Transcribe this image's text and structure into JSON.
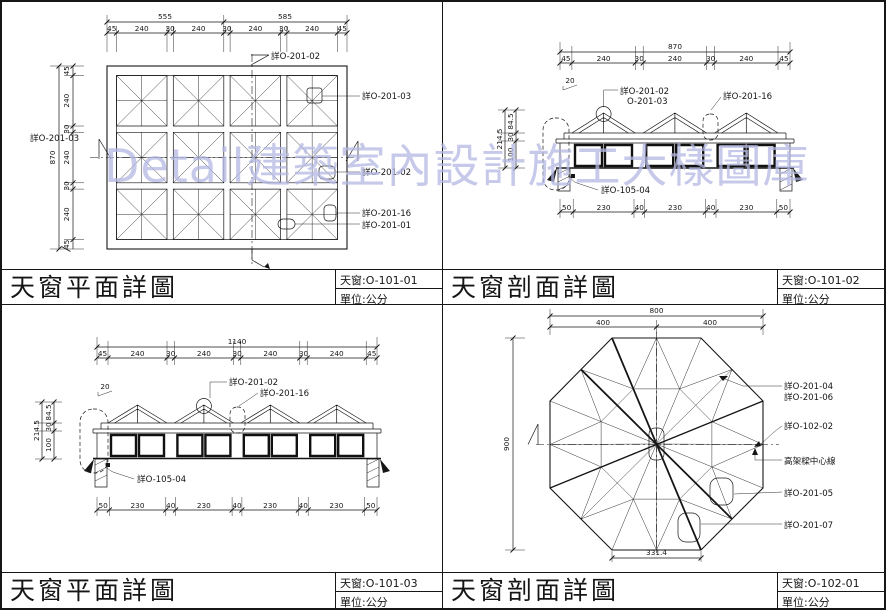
{
  "watermark": {
    "text": "Detail建築室內設計施工大樣圖庫",
    "color": "#b4b8e2"
  },
  "panels": {
    "tl": {
      "title": "天窗平面詳圖",
      "sheet": "天窗:O-101-01",
      "unit": "單位:公分",
      "dim_total_top": [
        "555",
        "585"
      ],
      "dims_top": [
        "45",
        "240",
        "30",
        "240",
        "30",
        "240",
        "30",
        "240",
        "45"
      ],
      "dim_total_left": "870",
      "dims_left": [
        "45",
        "240",
        "30",
        "240",
        "30",
        "240",
        "45"
      ],
      "labels": {
        "top": "詳O-201-02",
        "left": "詳O-201-03",
        "right1": "詳O-201-03",
        "right2": "詳O-201-02",
        "right3": "詳O-201-16",
        "right4": "詳O-201-01"
      }
    },
    "tr": {
      "title": "天窗剖面詳圖",
      "sheet": "天窗:O-101-02",
      "unit": "單位:公分",
      "dim_total_top": "870",
      "dims_top": [
        "45",
        "240",
        "30",
        "240",
        "30",
        "240",
        "45"
      ],
      "dims_bottom": [
        "50",
        "230",
        "40",
        "230",
        "40",
        "230",
        "50"
      ],
      "dim_total_left": "214.5",
      "dims_left": [
        "84.5",
        "30",
        "100"
      ],
      "slope": "20",
      "labels": {
        "peak1": "詳O-201-02",
        "peak2": "O-201-03",
        "valley": "詳O-201-16",
        "wall": "詳O-105-04"
      }
    },
    "bl": {
      "title": "天窗平面詳圖",
      "sheet": "天窗:O-101-03",
      "unit": "單位:公分",
      "dim_total_top": "1140",
      "dims_top": [
        "45",
        "240",
        "30",
        "240",
        "30",
        "240",
        "30",
        "240",
        "45"
      ],
      "dims_bottom": [
        "50",
        "230",
        "40",
        "230",
        "40",
        "230",
        "40",
        "230",
        "50"
      ],
      "dim_total_left": "214.5",
      "dims_left": [
        "84.5",
        "30",
        "100"
      ],
      "slope": "20",
      "labels": {
        "peak": "詳O-201-02",
        "valley": "詳O-201-16",
        "wall": "詳O-105-04"
      }
    },
    "br": {
      "title": "天窗剖面詳圖",
      "sheet": "天窗:O-102-01",
      "unit": "單位:公分",
      "dim_total_top": "800",
      "dims_top": [
        "400",
        "400"
      ],
      "dim_left": "900",
      "dim_bottom": "331.4",
      "labels": {
        "l1": "詳O-201-04",
        "l2": "詳O-201-06",
        "l3": "詳O-102-02",
        "l4": "高架樑中心線",
        "l5": "詳O-201-05",
        "l6": "詳O-201-07"
      }
    }
  }
}
